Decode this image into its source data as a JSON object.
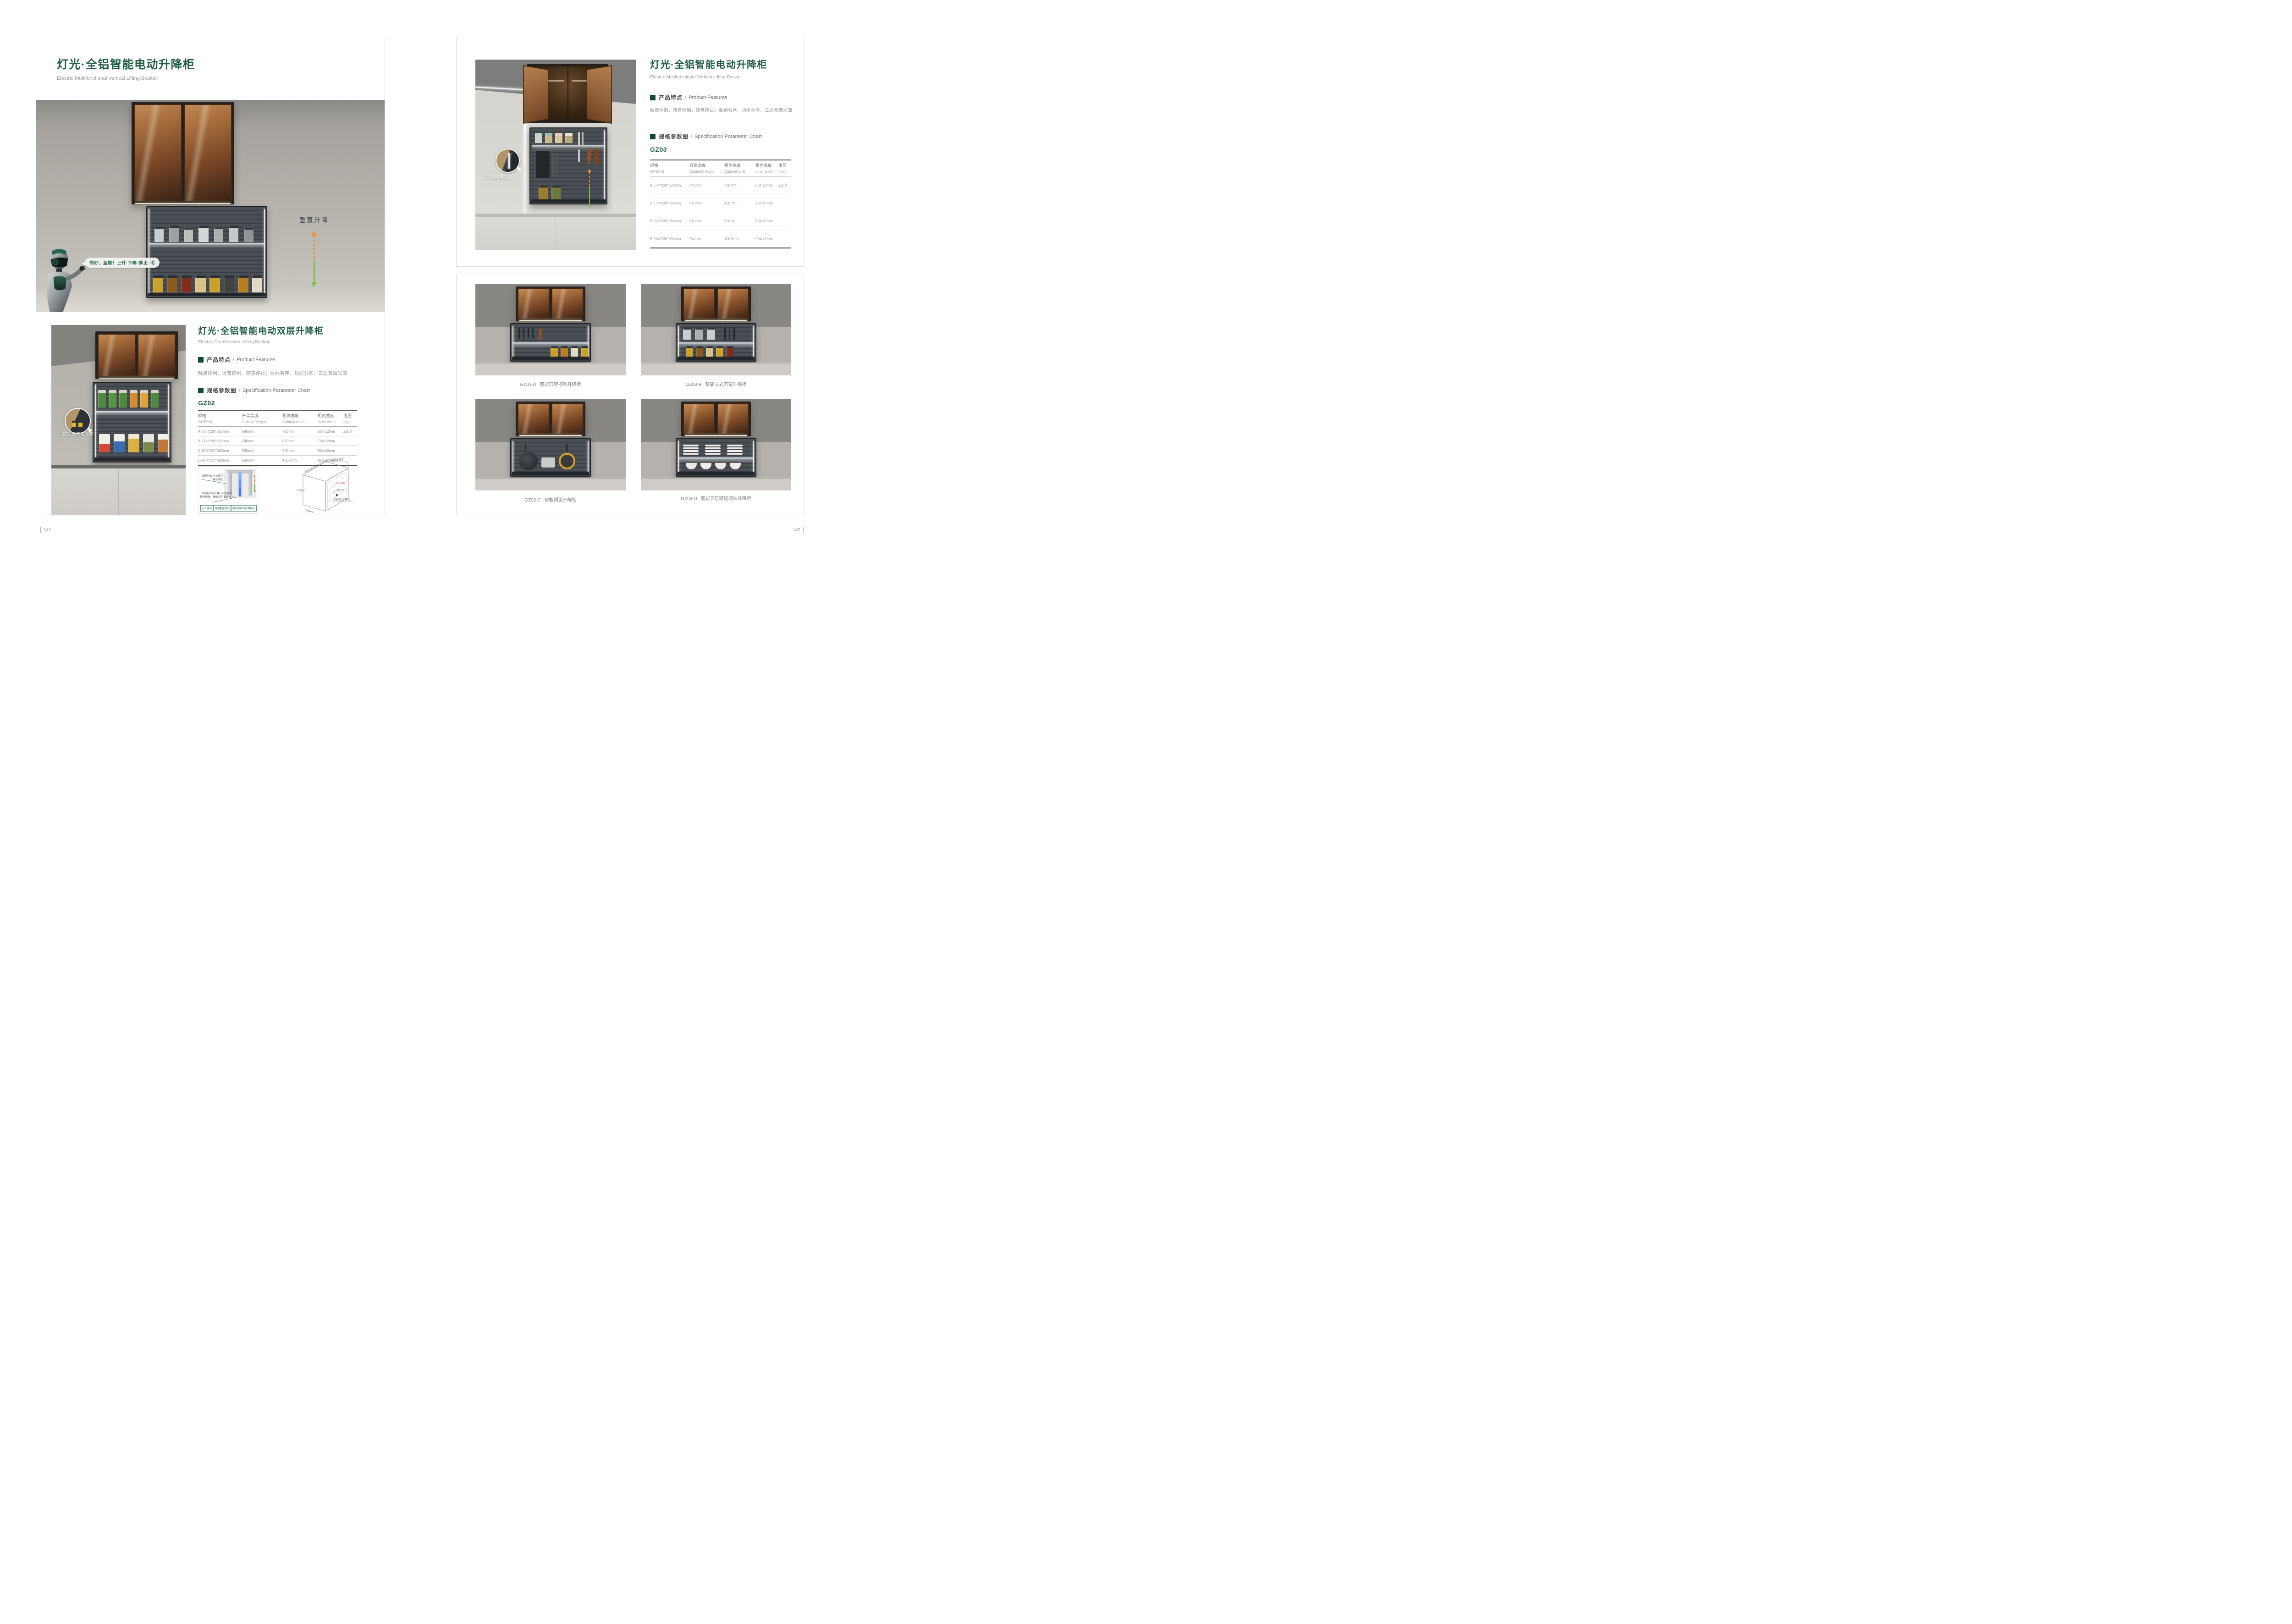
{
  "page": {
    "left_number": "141",
    "right_number": "142"
  },
  "colors": {
    "brand_green": "#215e45",
    "arrow_orange": "#f18f2f",
    "arrow_green": "#7abf4e",
    "dim_red": "#d84b3f"
  },
  "icons": {
    "sound_wave": ")))"
  },
  "left_page": {
    "title": "灯光·全铝智能电动升降柜",
    "subtitle": "Electric Multifunctional Vertical Lifting Basket",
    "hero": {
      "speech_text": "你好，蓝鲸！上升·下降·停止",
      "lift_label": "垂直升降"
    },
    "lower": {
      "photo_callout": "二层玻璃氛围光源",
      "title": "灯光·全铝智能电动双层升降柜",
      "subtitle": "Electric Double-layer Lifting Basket",
      "features_heading_zh": "产品特点",
      "features_heading_en": "Product Features",
      "features_text": "触摸控制、语音控制、随意停止；收纳有序、功能分区、三边氛围光源",
      "spec_heading_zh": "规格参数图",
      "spec_heading_en": "Specification Parameter Chart",
      "model": "GZ02"
    },
    "table": {
      "headers": [
        {
          "zh": "规格",
          "en": "(W*D*H)"
        },
        {
          "zh": "升高高度",
          "en": "Cabinet Height"
        },
        {
          "zh": "柜体宽度",
          "en": "Cabinet width"
        },
        {
          "zh": "柜内宽度",
          "en": "Inner width"
        },
        {
          "zh": "电压",
          "en": "Input"
        }
      ],
      "rows": [
        [
          "A:674*230*683mm",
          "540mm",
          "700mm",
          "664 ±2mm",
          "220V"
        ],
        [
          "B:774*230*683mm",
          "540mm",
          "800mm",
          "764 ±2mm",
          ""
        ],
        [
          "C:874*230*683mm",
          "540mm",
          "900mm",
          "864 ±2mm",
          ""
        ],
        [
          "D:974*230*683mm",
          "540mm",
          "1000mm",
          "964 ±2mm",
          ""
        ]
      ]
    },
    "mechanism": {
      "callout_top": "伺服电机·左右重型轴芯滑轨",
      "callout_bottom_line1": "中间旋转同步螺杆平衡受力",
      "callout_bottom_line2": "静密顺滑，静谧无声·载重量大",
      "badges": [
        "行业独创",
        "两边重型滑轨",
        "中间平衡同步螺旋杆"
      ]
    },
    "dimensions": {
      "width_options": "700/800/900/1000mm",
      "outlet_hole": "∅35出线孔",
      "height": "700mm",
      "depth": "330mm",
      "clearance": "220mm",
      "offset": "46mm",
      "switch_hole": "∅35深15开关"
    }
  },
  "right_page": {
    "title": "灯光·全铝智能电动升降柜",
    "subtitle": "Electric Multifunctional Vertical Lifting Basket",
    "features_heading_zh": "产品特点",
    "features_heading_en": "Product Features",
    "features_text": "触摸控制、语音控制、随意停止；收纳有序、功能分区、三边氛围光源",
    "spec_heading_zh": "规格参数图",
    "spec_heading_en": "Specification Parameter Chart",
    "model": "GZ03",
    "photo": {
      "callout": "三边氛围光源",
      "lift_label": "垂直升降"
    },
    "table": {
      "headers": [
        {
          "zh": "规格",
          "en": "(W*D*H)"
        },
        {
          "zh": "升高高度",
          "en": "Cabinet Height"
        },
        {
          "zh": "柜体宽度",
          "en": "Cabinet width"
        },
        {
          "zh": "柜内宽度",
          "en": "Inner width"
        },
        {
          "zh": "电压",
          "en": "Input"
        }
      ],
      "rows": [
        [
          "A:674*230*683mm",
          "540mm",
          "700mm",
          "664 ±2mm",
          "220V"
        ],
        [
          "B:774*230*683mm",
          "540mm",
          "800mm",
          "764 ±2mm",
          ""
        ],
        [
          "B:874*230*683mm",
          "540mm",
          "900mm",
          "864 ±2mm",
          ""
        ],
        [
          "B:974*230*683mm",
          "540mm",
          "1000mm",
          "964 ±2mm",
          ""
        ]
      ]
    },
    "products": [
      {
        "code": "GZ03-A",
        "name": "智能刀架挂钩升降柜"
      },
      {
        "code": "GZ03-B",
        "name": "智能立式刀架升降柜"
      },
      {
        "code": "GZ03-C",
        "name": "智能锅盖升降柜"
      },
      {
        "code": "GZ03-D",
        "name": "智能三层碗碟调味升降柜"
      }
    ]
  }
}
